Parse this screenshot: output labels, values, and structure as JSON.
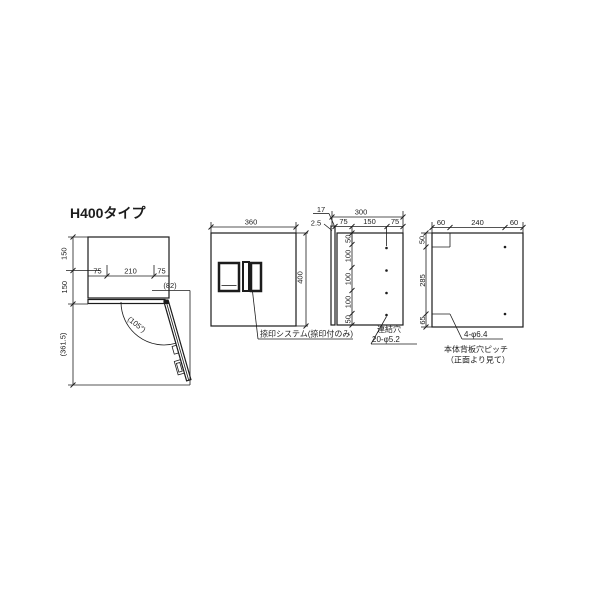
{
  "title": "H400タイプ",
  "colors": {
    "panel": "#d8d8d8",
    "line": "#1c1c1c",
    "background": "#ffffff"
  },
  "open_view": {
    "dim_depth_top": "150",
    "dim_depth_bottom": "150",
    "dim_width_left": "75",
    "dim_width_center": "210",
    "dim_width_right": "75",
    "dim_protrusion": "(82)",
    "dim_door_angle": "(105°)",
    "dim_door_reach": "(361.5)"
  },
  "front_view": {
    "dim_width": "360",
    "dim_height": "400",
    "stamp_note": "捺印システム(捺印付のみ)"
  },
  "side_view": {
    "dim_depth": "300",
    "dim_door_thickness": "17",
    "dim_gap": "2.5",
    "dim_top_left": "75",
    "dim_top_center": "150",
    "dim_top_right": "75",
    "dim_v": [
      "50",
      "100",
      "100",
      "100",
      "50"
    ],
    "holes_label_line1": "連結穴",
    "holes_label_line2": "20-φ5.2"
  },
  "back_view": {
    "dim_top_left": "60",
    "dim_top_center": "240",
    "dim_top_right": "60",
    "dim_left_top": "50",
    "dim_left_center": "285",
    "dim_left_bottom": "65",
    "holes_label": "4-φ6.4",
    "note_line1": "本体背板穴ピッチ",
    "note_line2": "（正面より見て）"
  }
}
